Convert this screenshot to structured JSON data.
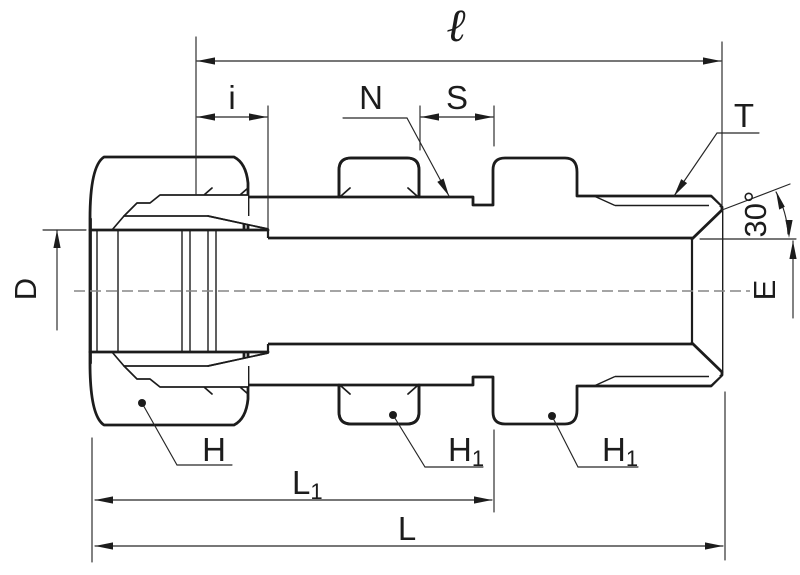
{
  "drawing": {
    "title": "tube-fitting-bulkhead-male-connector-section",
    "labels": {
      "ell": "ℓ",
      "i": "i",
      "n": "N",
      "s": "S",
      "t": "T",
      "d": "D",
      "e": "E",
      "angle": "30°",
      "h": "H",
      "h1": "H",
      "h1_sub": "1",
      "l1": "L",
      "l1_sub": "1",
      "l": "L"
    },
    "colors": {
      "background": "#ffffff",
      "nut": "#c7c7c7",
      "body": "#e9e9e9",
      "ferrule": "#a8a8a8",
      "line": "#1c1c1c",
      "centerline": "#858585",
      "dimension": "#262626"
    }
  }
}
